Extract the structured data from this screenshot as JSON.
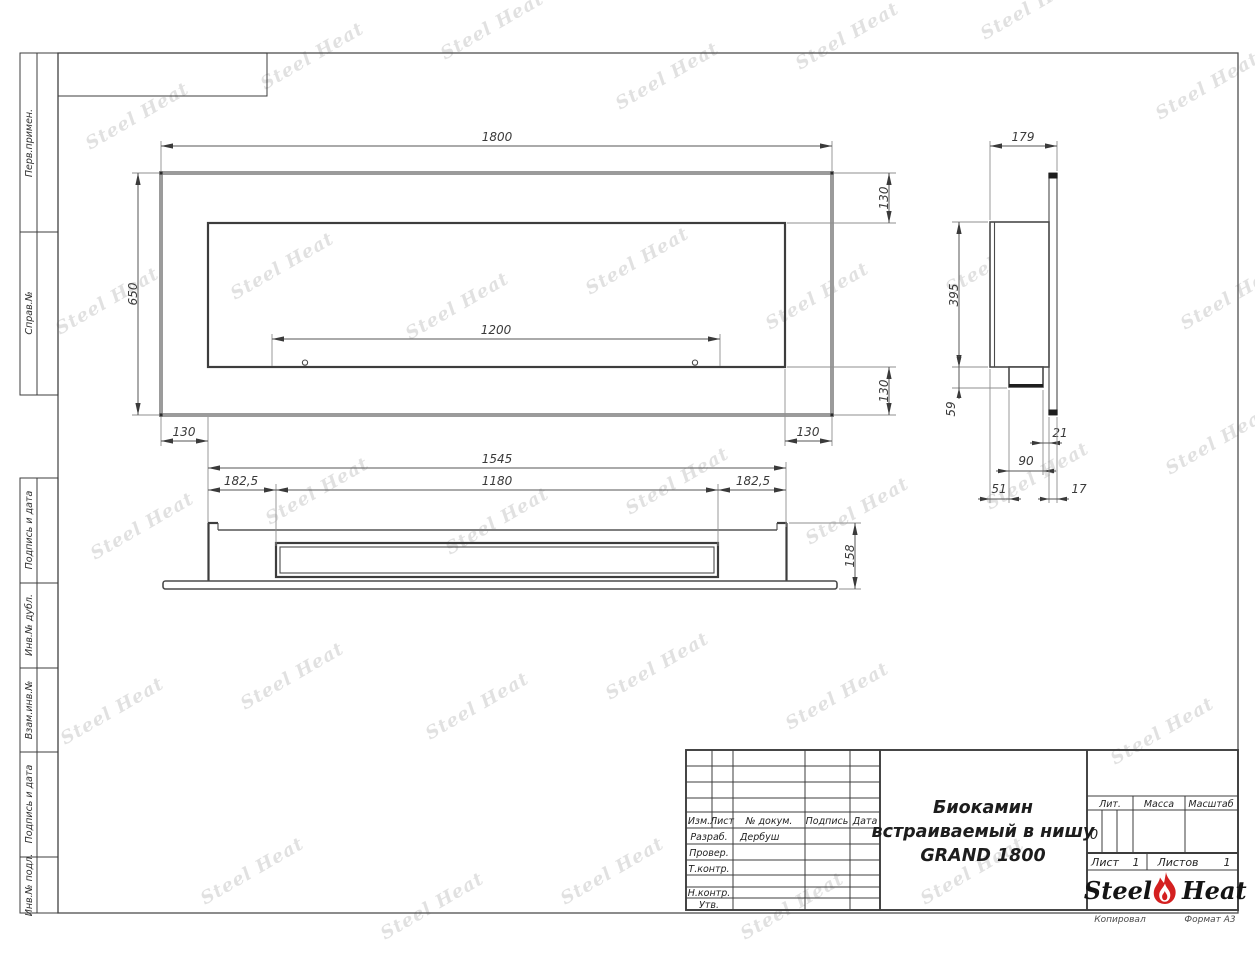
{
  "page": {
    "copied": "Копировал",
    "format": "Формат А3"
  },
  "watermark": "Steel Heat",
  "margin_labels": [
    "Перв.примен.",
    "Справ.№",
    "Подпись и дата",
    "Инв.№ дубл.",
    "Взам.инв.№",
    "Подпись и дата",
    "Инв.№ подл."
  ],
  "title_block": {
    "rev_headers": [
      "Изм.",
      "Лист",
      "№ докум.",
      "Подпись",
      "Дата"
    ],
    "roles": [
      "Разраб.",
      "Провер.",
      "Т.контр.",
      "Н.контр.",
      "Утв."
    ],
    "developer": "Дербуш",
    "title_line1": "Биокамин",
    "title_line2": "встраиваемый в нишу",
    "title_line3": "GRAND 1800",
    "lit_label": "Лит.",
    "lit_value": "0",
    "mass_label": "Масса",
    "scale_label": "Масштаб",
    "sheet_label": "Лист",
    "sheet_number": "1",
    "sheets_label": "Листов",
    "sheets_total": "1",
    "logo_steel": "Steel",
    "logo_heat": "Heat"
  },
  "dims": {
    "front_width": "1800",
    "front_height": "650",
    "burner_width": "1200",
    "frame_margin": "130",
    "body_length": "1545",
    "side_offset": "182,5",
    "slot_length": "1180",
    "body_height_total": "158",
    "depth": "179",
    "niche_height": "395",
    "bottom_step": "59",
    "panel_gap": "21",
    "foot_depth": "90",
    "back_gap": "51",
    "front_overhang": "17"
  },
  "colors": {
    "flame_red": "#d42020",
    "line_dark": "#3d3d3d",
    "line_gray": "#9b9b9b"
  }
}
